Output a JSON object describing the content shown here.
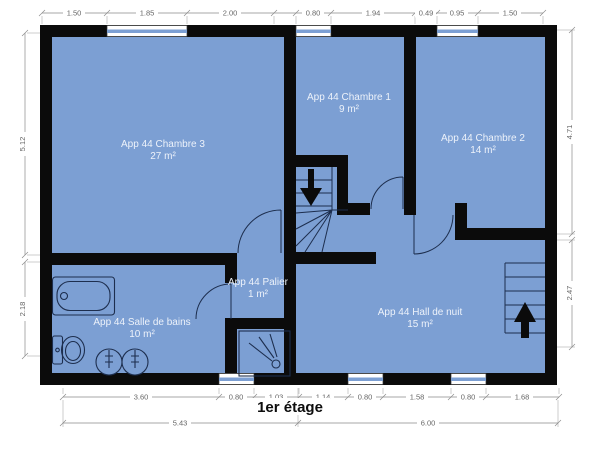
{
  "title": "1er étage",
  "colors": {
    "floor": "#7c9fd3",
    "wall": "#0b0b0b",
    "dimension_line": "#8a8a8a",
    "dimension_text": "#666666",
    "room_label_text": "#edf2fa",
    "fixture_line": "#1d2e4e",
    "background": "#ffffff"
  },
  "rooms": [
    {
      "name": "App 44 Chambre 3",
      "area": "27 m²"
    },
    {
      "name": "App 44 Chambre 1",
      "area": "9 m²"
    },
    {
      "name": "App 44 Chambre 2",
      "area": "14 m²"
    },
    {
      "name": "App 44 Palier",
      "area": "1 m²"
    },
    {
      "name": "App 44 Salle de bains",
      "area": "10 m²"
    },
    {
      "name": "App 44 Hall de nuit",
      "area": "15 m²"
    }
  ],
  "dims": {
    "top": [
      "1.50",
      "1.85",
      "2.00",
      "0.80",
      "1.94",
      "0.49",
      "0.95",
      "1.50"
    ],
    "bottom": [
      "3.60",
      "0.80",
      "1.03",
      "1.14",
      "0.80",
      "1.58",
      "0.80",
      "1.68"
    ],
    "bottom_totals": [
      "5.43",
      "6.00"
    ],
    "left": [
      "5.12",
      "2.18"
    ],
    "right": [
      "4.71",
      "2.47"
    ]
  },
  "icons": [
    "stairs-down-arrow",
    "stairs-up-arrow",
    "bathtub",
    "toilet",
    "sink",
    "shower",
    "door-swing"
  ]
}
